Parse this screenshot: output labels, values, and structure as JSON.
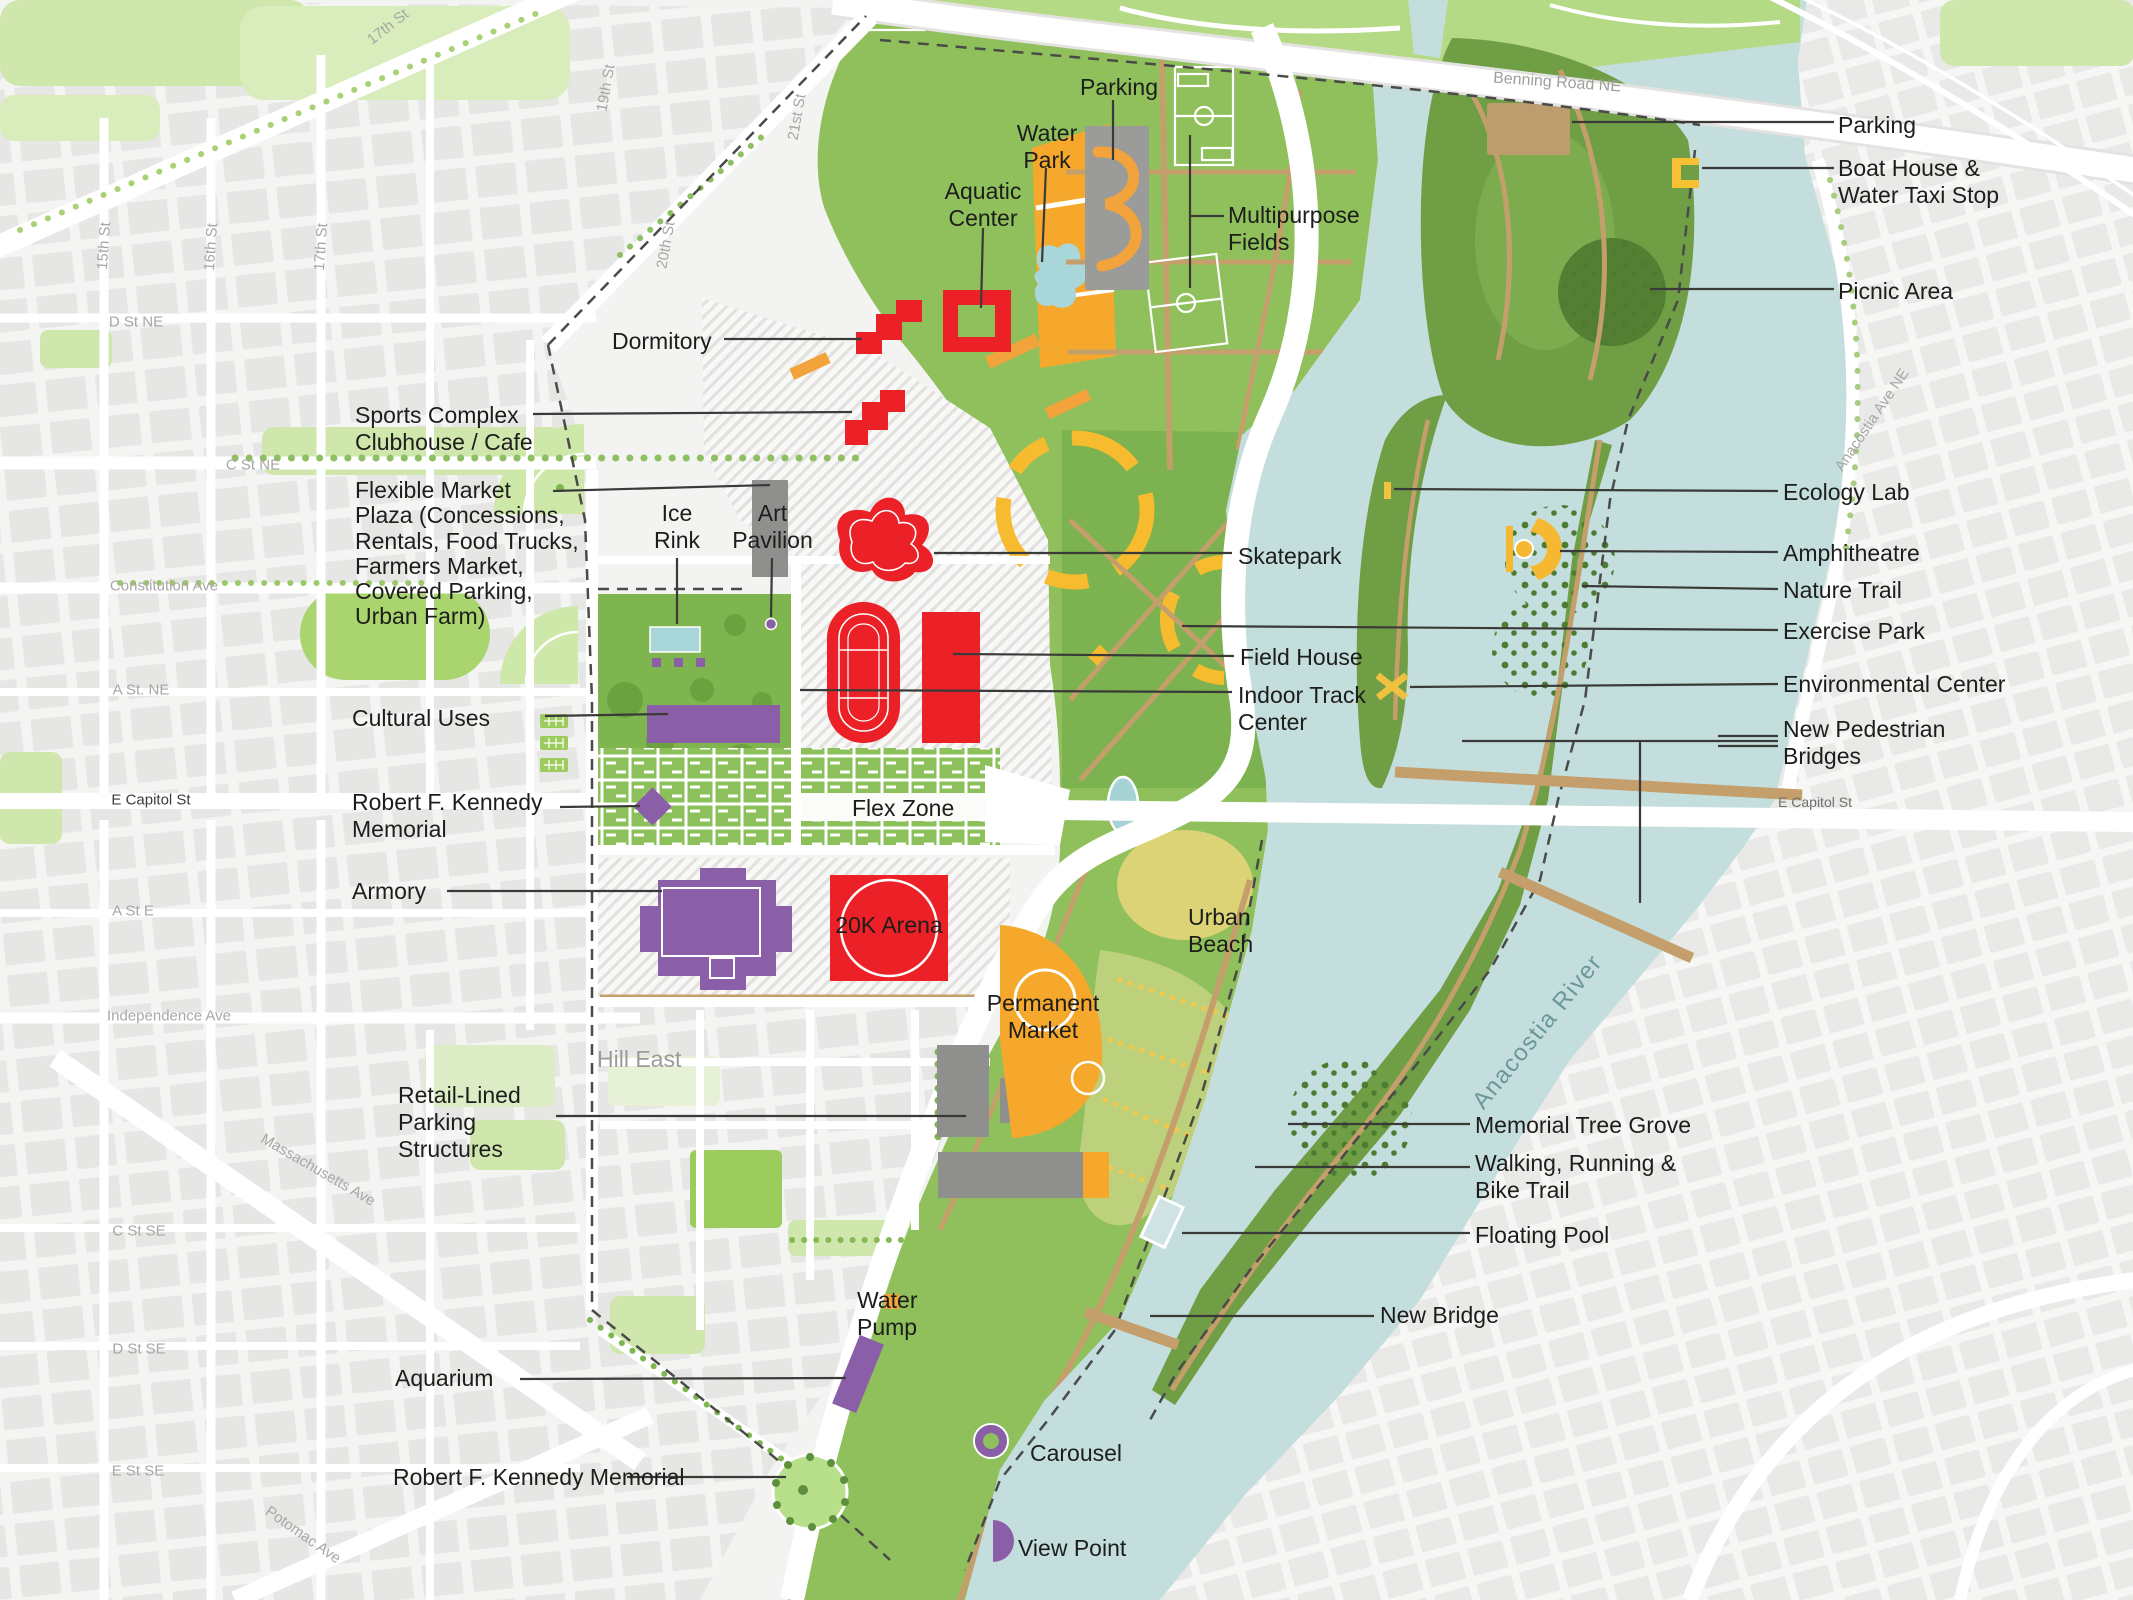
{
  "title": "Anacostia riverfront stadium-site master plan",
  "callouts": {
    "parking_top": "Parking",
    "water_park": "Water\nPark",
    "aquatic_center": "Aquatic\nCenter",
    "dormitory": "Dormitory",
    "sports_complex": "Sports Complex\nClubhouse / Cafe",
    "flexible_market": "Flexible Market\nPlaza (Concessions,\nRentals, Food Trucks,\nFarmers Market,\nCovered Parking,\nUrban Farm)",
    "ice_rink": "Ice\nRink",
    "art_pavilion": "Art\nPavilion",
    "cultural_uses": "Cultural Uses",
    "rfk_memorial": "Robert F. Kennedy\nMemorial",
    "armory": "Armory",
    "retail_parking": "Retail-Lined\nParking\nStructures",
    "aquarium": "Aquarium",
    "rfk_memorial_south": "Robert F. Kennedy Memorial",
    "multipurpose_fields": "Multipurpose\nFields",
    "skatepark": "Skatepark",
    "field_house": "Field House",
    "indoor_track": "Indoor Track\nCenter",
    "flex_zone": "Flex Zone",
    "arena": "20K Arena",
    "urban_beach": "Urban\nBeach",
    "permanent_market": "Permanent\nMarket",
    "water_pump": "Water\nPump",
    "carousel": "Carousel",
    "view_point": "View Point",
    "parking_ne": "Parking",
    "boat_house": "Boat House &\nWater Taxi Stop",
    "picnic_area": "Picnic Area",
    "ecology_lab": "Ecology Lab",
    "amphitheatre": "Amphitheatre",
    "nature_trail": "Nature Trail",
    "exercise_park": "Exercise Park",
    "environmental_center": "Environmental Center",
    "pedestrian_bridges": "New Pedestrian\nBridges",
    "memorial_tree_grove": "Memorial Tree Grove",
    "walking_trail": "Walking, Running &\nBike Trail",
    "floating_pool": "Floating Pool",
    "new_bridge": "New Bridge"
  },
  "streets": {
    "fifteenth": "15th St",
    "sixteenth": "16th St",
    "seventeenth": "17th St",
    "seventeenth_nw": "17th St",
    "nineteenth": "19th St",
    "twentieth": "20th St",
    "twentyfirst": "21st St",
    "d_st_ne": "D St NE",
    "c_st_ne": "C St NE",
    "constitution": "Constitution Ave",
    "a_st_ne": "A St. NE",
    "e_capitol_w": "E Capitol St",
    "a_st_e": "A St E",
    "independence": "Independence Ave",
    "massachusetts": "Massachusetts Ave",
    "c_st_se": "C St SE",
    "d_st_se": "D St SE",
    "e_st_se": "E St SE",
    "potomac": "Potomac Ave",
    "benning": "Benning Road NE",
    "e_capitol_e": "E Capitol St",
    "anacostia_ave": "Anacostia Ave NE"
  },
  "areas": {
    "hill_east": "Hill East"
  },
  "water": {
    "river": "Anacostia River"
  },
  "colors": {
    "sports_red": "#ec2127",
    "civic_purple": "#8a5fa8",
    "plaza_orange": "#f5a82c",
    "field_green": "#8fc05c",
    "island_green": "#6f9e45",
    "water_teal": "#c3dedd",
    "path_tan": "#c59f6b",
    "label_ink": "#1d1d1b",
    "street_gray": "#a7a7a5"
  }
}
